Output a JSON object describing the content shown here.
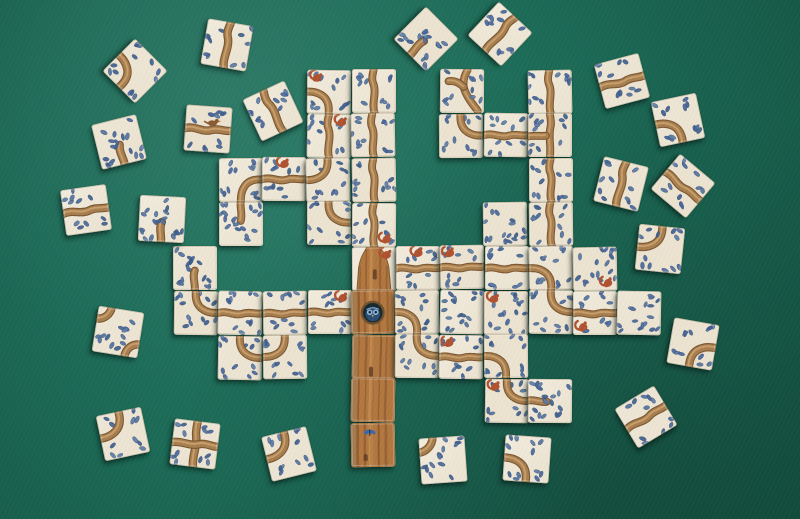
{
  "scene": {
    "description": "Tree-building tile game spread on a green felt table: a connected tree of square cards (trunk with an owl hollow, branches, blue leaves, red squirrels) plus loose scattered tiles around it",
    "table_color": "#1c6b57"
  },
  "board": {
    "origin_x": 174,
    "origin_y": 69,
    "pitch": 44.3,
    "tile_size": 43.5,
    "loose_tile_size": 46
  },
  "palette": {
    "felt_light": "#247a63",
    "felt_mid": "#1c6b57",
    "felt_dark": "#124f40",
    "tile_faces": [
      "#f2ecdd",
      "#efe7d6",
      "#ece3d0"
    ],
    "tile_edge": "#b7ad96",
    "branch_dark": "#7c5832",
    "branch_mid": "#a87e4e",
    "branch_light": "#cfa873",
    "leaf_colors": [
      "#4a689b",
      "#54739e",
      "#40608f",
      "#5e7ca6"
    ],
    "leaf_stroke": "#33507d",
    "trunk_base": "#b3773f",
    "trunk_streak": "#6b4526",
    "trunk_light": "#dca467",
    "trunk_gray": "#98805c",
    "trunk_knot": "#5a3a20",
    "hollow": "#16292e",
    "hollow_ring": "#70512c",
    "owl_body": "#2b4d73",
    "owl_eye": "#8fb2d3",
    "owl_pupil": "#0b1a2b",
    "owl_beak": "#d8b069",
    "squirrel": "#b05231",
    "bird": "#8a5a33",
    "bird_beak": "#c98a3a",
    "butterfly": "#3e68ad"
  },
  "tile_legend": {
    "V": "vertical-branch",
    "H": "horizontal-branch",
    "CTR": "curve-top-right",
    "CTL": "curve-top-left",
    "CBL": "curve-bottom-left",
    "CBR": "curve-bottom-right",
    "CRB": "curve-right-bottom",
    "ET": "branch-end-top",
    "EB": "branch-end-bottom",
    "ER": "branch-end-right",
    "X": "branch-cross",
    "VL": "branch-tee-left",
    "L": "leaves-only",
    "DC": "double-corner-curves",
    "QTL": "corner-arc",
    "YF": "branch-fork",
    "TT": "trunk-top",
    "T": "trunk",
    "TO": "trunk-owl-hollow",
    "TB": "trunk-butterfly"
  },
  "cluster_tiles": [
    {
      "col": 3,
      "row": 0,
      "type": "CBL",
      "squirrel": "tl"
    },
    {
      "col": 4,
      "row": 0,
      "type": "V"
    },
    {
      "col": 3,
      "row": 1,
      "type": "V",
      "squirrel": "tr"
    },
    {
      "col": 4,
      "row": 1,
      "type": "V"
    },
    {
      "col": 1,
      "row": 2,
      "type": "CRB"
    },
    {
      "col": 2,
      "row": 2,
      "type": "H",
      "squirrel": "tc"
    },
    {
      "col": 3,
      "row": 2,
      "type": "CTL"
    },
    {
      "col": 4,
      "row": 2,
      "type": "V"
    },
    {
      "col": 1,
      "row": 3,
      "type": "ET"
    },
    {
      "col": 3,
      "row": 3,
      "type": "CTR"
    },
    {
      "col": 4,
      "row": 3,
      "type": "V",
      "squirrel": "br"
    },
    {
      "col": 6,
      "row": 0,
      "type": "YF"
    },
    {
      "col": 8,
      "row": 0,
      "type": "V"
    },
    {
      "col": 6,
      "row": 1,
      "type": "CTR"
    },
    {
      "col": 7,
      "row": 1,
      "type": "H"
    },
    {
      "col": 8,
      "row": 1,
      "type": "VL"
    },
    {
      "col": 8,
      "row": 2,
      "type": "V"
    },
    {
      "col": 7,
      "row": 3,
      "type": "L"
    },
    {
      "col": 8,
      "row": 3,
      "type": "V"
    },
    {
      "col": 0,
      "row": 4,
      "type": "EB"
    },
    {
      "col": 4,
      "row": 4,
      "type": "TT",
      "squirrel": "tr"
    },
    {
      "col": 5,
      "row": 4,
      "type": "H",
      "squirrel": "tc"
    },
    {
      "col": 6,
      "row": 4,
      "type": "H",
      "squirrel": "tl"
    },
    {
      "col": 7,
      "row": 4,
      "type": "H"
    },
    {
      "col": 8,
      "row": 4,
      "type": "CBL"
    },
    {
      "col": 9,
      "row": 4,
      "type": "L",
      "squirrel": "br"
    },
    {
      "col": 0,
      "row": 5,
      "type": "CTR"
    },
    {
      "col": 1,
      "row": 5,
      "type": "H"
    },
    {
      "col": 2,
      "row": 5,
      "type": "H"
    },
    {
      "col": 3,
      "row": 5,
      "type": "H",
      "squirrel": "tr"
    },
    {
      "col": 4,
      "row": 5,
      "type": "TO"
    },
    {
      "col": 5,
      "row": 5,
      "type": "CBL"
    },
    {
      "col": 6,
      "row": 5,
      "type": "L"
    },
    {
      "col": 7,
      "row": 5,
      "type": "L",
      "squirrel": "tl"
    },
    {
      "col": 8,
      "row": 5,
      "type": "CTR"
    },
    {
      "col": 9,
      "row": 5,
      "type": "H",
      "squirrel": "bl"
    },
    {
      "col": 10,
      "row": 5,
      "type": "L"
    },
    {
      "col": 1,
      "row": 6,
      "type": "CTR"
    },
    {
      "col": 2,
      "row": 6,
      "type": "CTL"
    },
    {
      "col": 4,
      "row": 6,
      "type": "T"
    },
    {
      "col": 5,
      "row": 6,
      "type": "CTR"
    },
    {
      "col": 6,
      "row": 6,
      "type": "H",
      "squirrel": "tl"
    },
    {
      "col": 7,
      "row": 6,
      "type": "CBL"
    },
    {
      "col": 4,
      "row": 7,
      "type": "T"
    },
    {
      "col": 7,
      "row": 7,
      "type": "CTR",
      "squirrel": "tl"
    },
    {
      "col": 8,
      "row": 7,
      "type": "ER"
    },
    {
      "col": 4,
      "row": 8,
      "type": "TB"
    }
  ],
  "loose_tiles": [
    {
      "x": 112,
      "y": 48,
      "rot": 45,
      "type": "CBL"
    },
    {
      "x": 204,
      "y": 22,
      "rot": 10,
      "type": "V"
    },
    {
      "x": 96,
      "y": 119,
      "rot": -14,
      "type": "EB"
    },
    {
      "x": 185,
      "y": 106,
      "rot": 4,
      "type": "H",
      "bird": true
    },
    {
      "x": 250,
      "y": 88,
      "rot": -25,
      "type": "V"
    },
    {
      "x": 63,
      "y": 187,
      "rot": -8,
      "type": "H"
    },
    {
      "x": 139,
      "y": 196,
      "rot": 3,
      "type": "EB"
    },
    {
      "x": 95,
      "y": 309,
      "rot": 9,
      "type": "DC"
    },
    {
      "x": 403,
      "y": 16,
      "rot": 45,
      "type": "EB"
    },
    {
      "x": 477,
      "y": 11,
      "rot": 43,
      "type": "V"
    },
    {
      "x": 599,
      "y": 58,
      "rot": -15,
      "type": "H"
    },
    {
      "x": 655,
      "y": 97,
      "rot": -12,
      "type": "CBL"
    },
    {
      "x": 598,
      "y": 161,
      "rot": 14,
      "type": "V"
    },
    {
      "x": 660,
      "y": 163,
      "rot": 40,
      "type": "H"
    },
    {
      "x": 637,
      "y": 226,
      "rot": 6,
      "type": "CTL"
    },
    {
      "x": 670,
      "y": 321,
      "rot": 10,
      "type": "CBR"
    },
    {
      "x": 100,
      "y": 411,
      "rot": -12,
      "type": "CTL"
    },
    {
      "x": 172,
      "y": 421,
      "rot": 7,
      "type": "X"
    },
    {
      "x": 266,
      "y": 431,
      "rot": -14,
      "type": "CTL"
    },
    {
      "x": 420,
      "y": 437,
      "rot": -4,
      "type": "QTL"
    },
    {
      "x": 504,
      "y": 436,
      "rot": 4,
      "type": "CBL"
    },
    {
      "x": 623,
      "y": 394,
      "rot": -31,
      "type": "H"
    }
  ]
}
